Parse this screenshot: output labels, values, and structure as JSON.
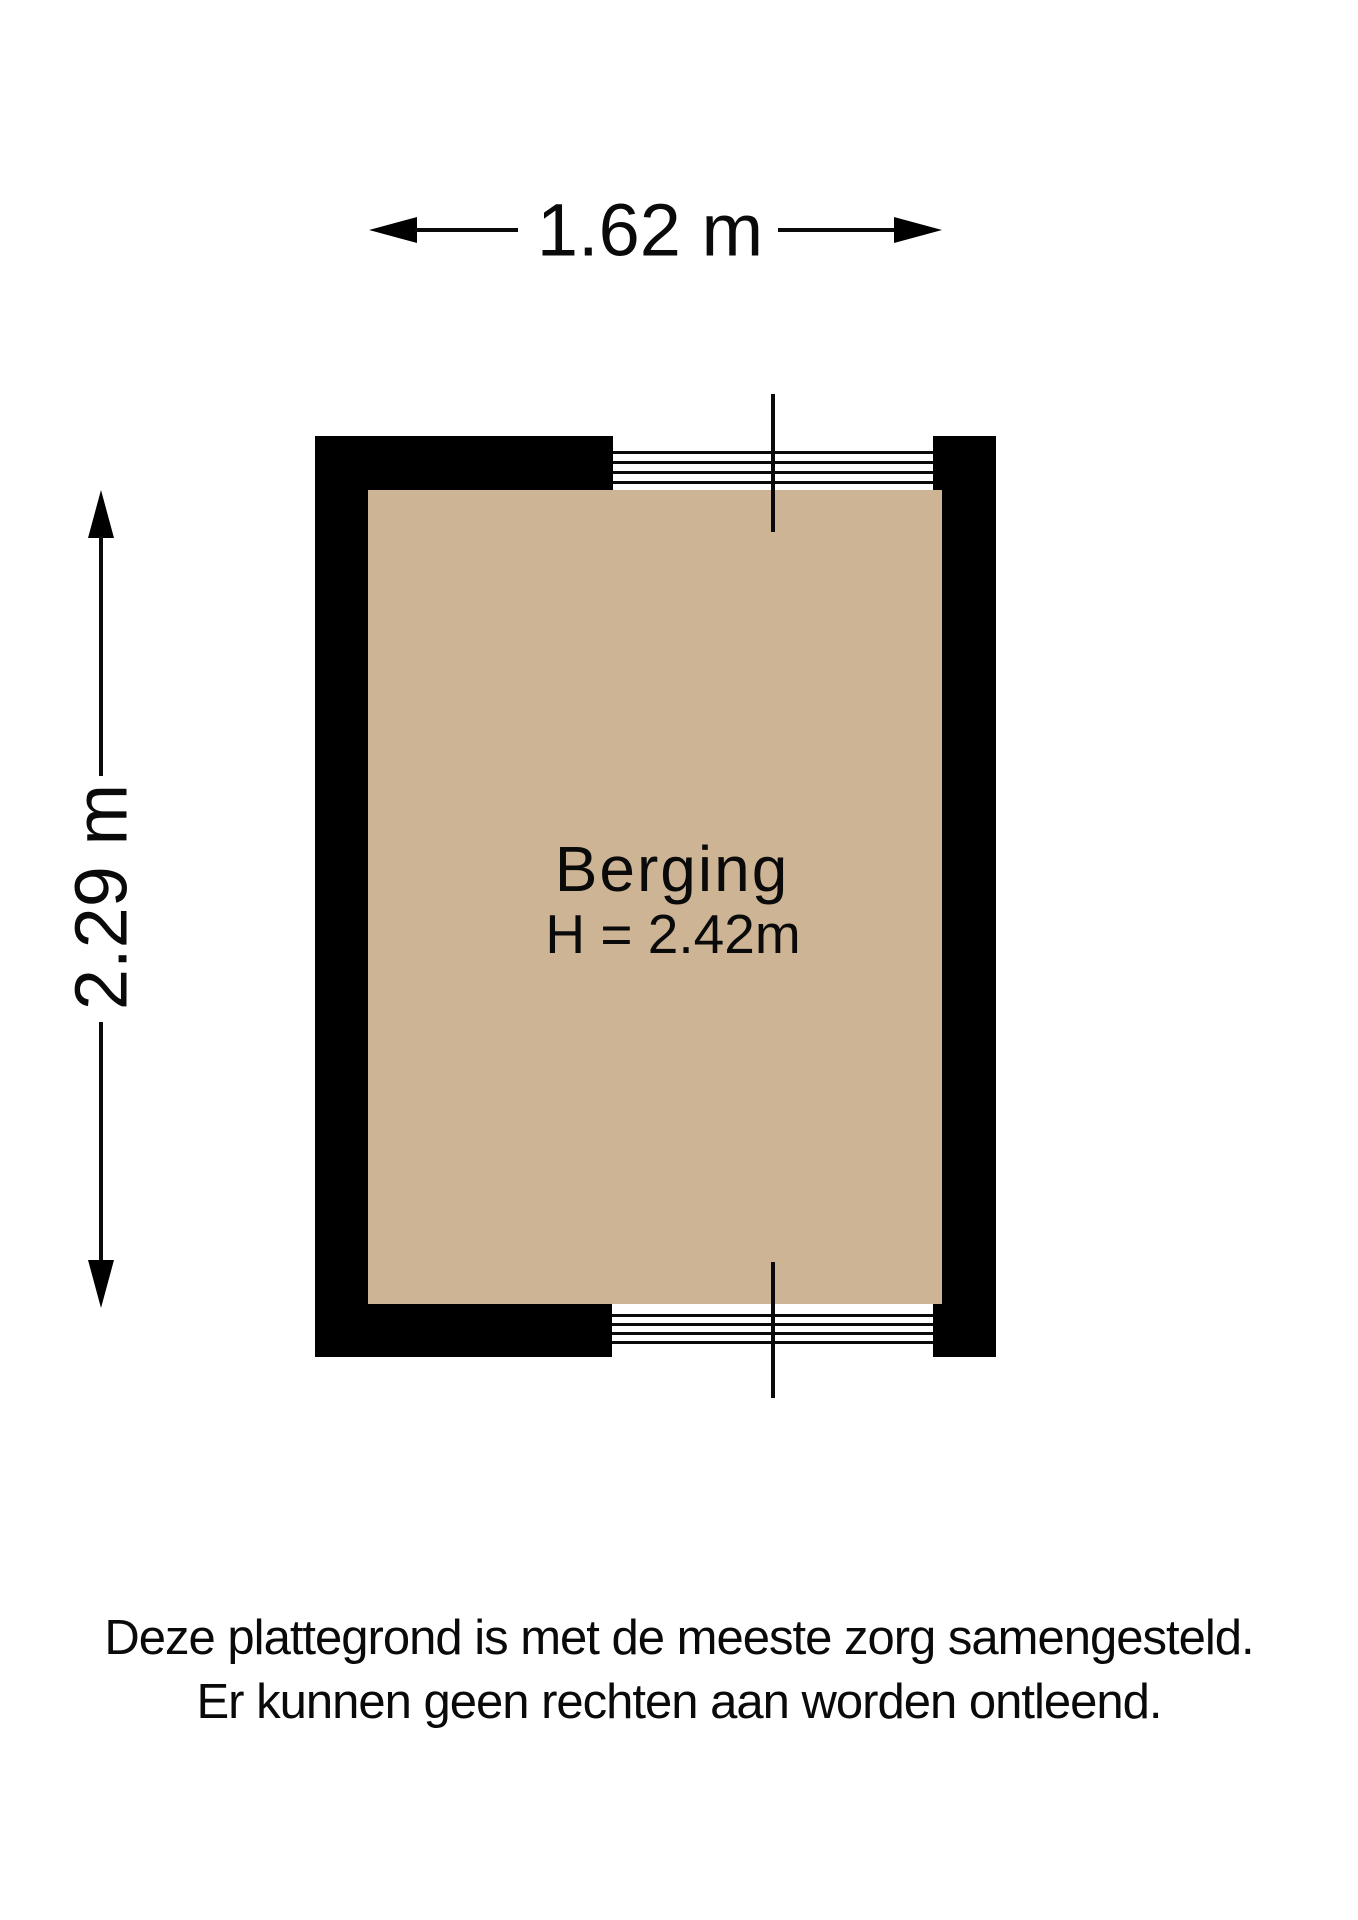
{
  "floor_plan": {
    "room": {
      "name": "Berging",
      "ceiling_height_label": "H = 2.42m"
    },
    "dimensions": {
      "width_label": "1.62 m",
      "height_label": "2.29 m"
    },
    "colors": {
      "wall": "#000000",
      "floor": "#cdb495",
      "background": "#ffffff",
      "line": "#0a0a0a"
    },
    "features": {
      "top_window_glazing_lines": 4,
      "bottom_window_glazing_lines": 4
    }
  },
  "disclaimer": {
    "line1": "Deze plattegrond is met de meeste zorg samengesteld.",
    "line2": "Er kunnen geen rechten aan worden ontleend."
  }
}
